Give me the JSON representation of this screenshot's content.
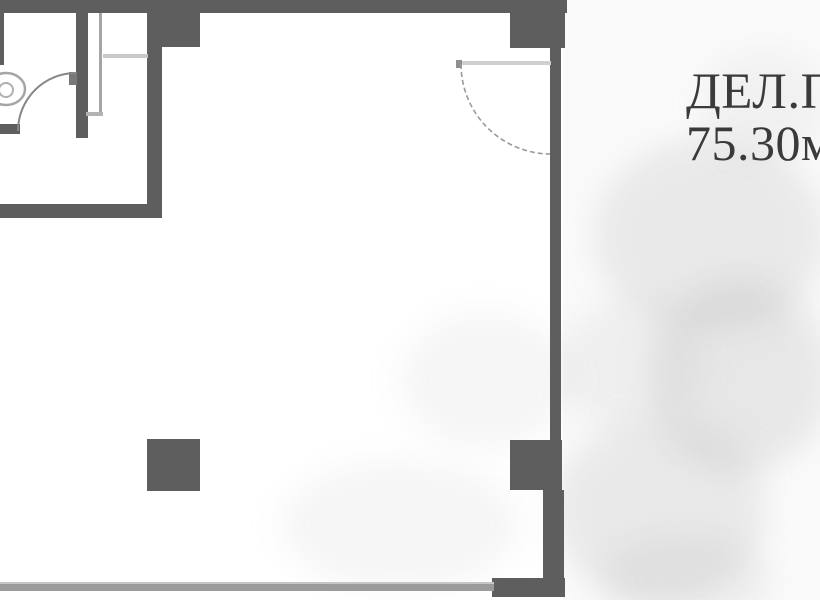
{
  "floorplan": {
    "label_line1": "ДЕЛ.П",
    "label_line2": "75.30м",
    "colors": {
      "wall": "#5e5e5e",
      "notch": "#787878",
      "thin": "#c9c9c9",
      "mid": "#a5a5a5",
      "arc": "#878787",
      "leaf": "#cfcfcf",
      "bottom_line": "#9b9b9b",
      "text": "#3a3a3a"
    },
    "fixtures": {
      "toilet": "toilet-icon"
    }
  }
}
